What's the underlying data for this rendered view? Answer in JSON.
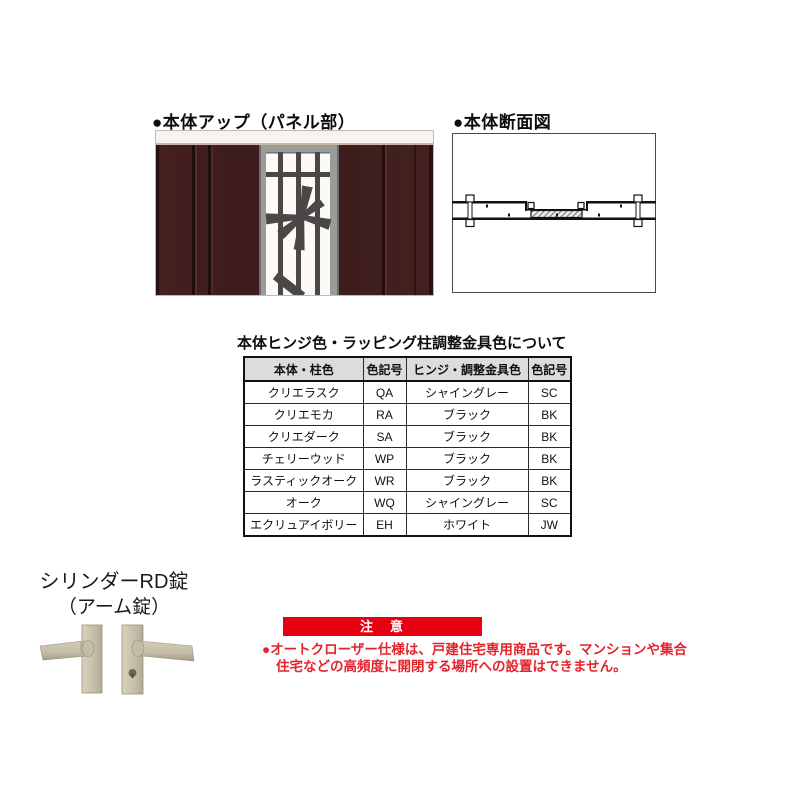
{
  "panel_section": {
    "heading": "●本体アップ（パネル部）",
    "image_alt": "door-panel-close-up"
  },
  "section_view": {
    "heading": "●本体断面図",
    "image_alt": "door-horizontal-cross-section"
  },
  "table_section": {
    "title": "本体ヒンジ色・ラッピング柱調整金具色について",
    "headers": [
      "本体・柱色",
      "色記号",
      "ヒンジ・調整金具色",
      "色記号"
    ],
    "rows": [
      [
        "クリエラスク",
        "QA",
        "シャイングレー",
        "SC"
      ],
      [
        "クリエモカ",
        "RA",
        "ブラック",
        "BK"
      ],
      [
        "クリエダーク",
        "SA",
        "ブラック",
        "BK"
      ],
      [
        "チェリーウッド",
        "WP",
        "ブラック",
        "BK"
      ],
      [
        "ラスティックオーク",
        "WR",
        "ブラック",
        "BK"
      ],
      [
        "オーク",
        "WQ",
        "シャイングレー",
        "SC"
      ],
      [
        "エクリュアイボリー",
        "EH",
        "ホワイト",
        "JW"
      ]
    ]
  },
  "lock_section": {
    "name_line1": "シリンダーRD錠",
    "name_line2": "（アーム錠）",
    "image_alt": "lever-handles-pair"
  },
  "notice": {
    "label": "注　意",
    "line1": "●オートクローザー仕様は、戸建住宅専用商品です。マンションや集合",
    "line2": "住宅などの高頻度に開閉する場所への設置はできません。"
  },
  "colors": {
    "brand_red": "#e60012",
    "notice_text_red": "#e2242c",
    "door_wood": "#3e1d1f",
    "window_frame_gray": "#9a9c9a",
    "grille_dark": "#4b4747",
    "handle_beige": "#c9c3ae",
    "table_header_bg": "#dcdcdc",
    "page_background": "#ffffff"
  }
}
